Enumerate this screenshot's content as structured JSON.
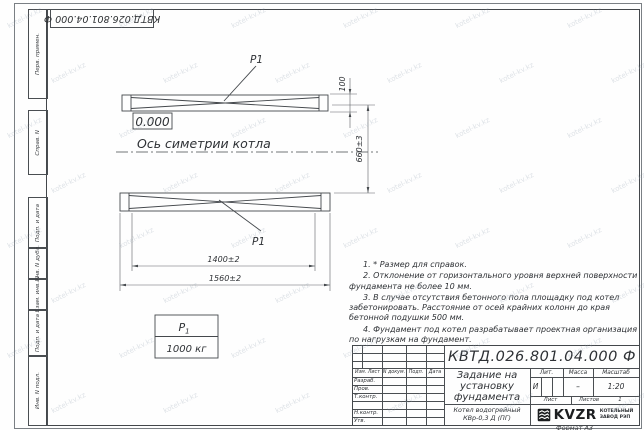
{
  "sheet": {
    "designation_stamp": "КВТД.026.801.04.000  Ф",
    "format_label": "Формат А3"
  },
  "watermark": {
    "text": "kotel-kv.kz"
  },
  "margin_labels": {
    "perv_primen": "Перв. примен.",
    "sprav_n": "Справ. N",
    "podp_i_data_1": "Подп. и дата",
    "inv_n_dubl": "Инв. N дубл.",
    "vzam_inv_n": "Взам. инв. N",
    "podp_i_data_2": "Подп. и дата",
    "inv_n_podl": "Инв. N подл."
  },
  "drawing": {
    "elevation_mark": "0.000",
    "axis_label": "Ось симетрии котла",
    "support_label_top": "Р1",
    "support_label_bottom": "Р1",
    "dim_rail_width": "100",
    "dim_rail_gap": "660±3",
    "dim_inner_length": "1400±2",
    "dim_overall_length": "1560±2",
    "load_table": {
      "symbol": "Р",
      "symbol_index": "1",
      "value": "1000 кг"
    }
  },
  "notes": [
    "1. * Размер для справок.",
    "2. Отклонение от горизонтального уровня верхней поверхности фундамента не более 10 мм.",
    "3. В случае отсутствия бетонного пола площадку под котел забетонировать. Расстояние от осей крайних колонн до края бетонной подушки 500 мм.",
    "4. Фундамент под котел разрабатывает проектная организация по нагрузкам на фундамент."
  ],
  "title_block": {
    "designation": "КВТД.026.801.04.000  Ф",
    "doc_title": "Задание на установку фундамента",
    "product": "Котел водогрейный КВр-0,3 Д (ПГ)",
    "columns": {
      "izm_list": "Изм. Лист",
      "doc_n": "N докум.",
      "podp": "Подп.",
      "data": "Дата"
    },
    "signature_rows": [
      "Разраб.",
      "Пров.",
      "Т.контр.",
      "",
      "Н.контр.",
      "Утв."
    ],
    "lit_label": "Лит.",
    "lit_value": "И",
    "mass_label": "Масса",
    "mass_value": "–",
    "scale_label": "Масштаб",
    "scale_value": "1:20",
    "sheet_label": "Лист",
    "sheets_label": "Листов",
    "sheets_value": "1",
    "logo_text": "KVZR",
    "logo_caption_line1": "КОТЕЛЬНЫЙ",
    "logo_caption_line2": "ЗАВОД РЭП"
  }
}
